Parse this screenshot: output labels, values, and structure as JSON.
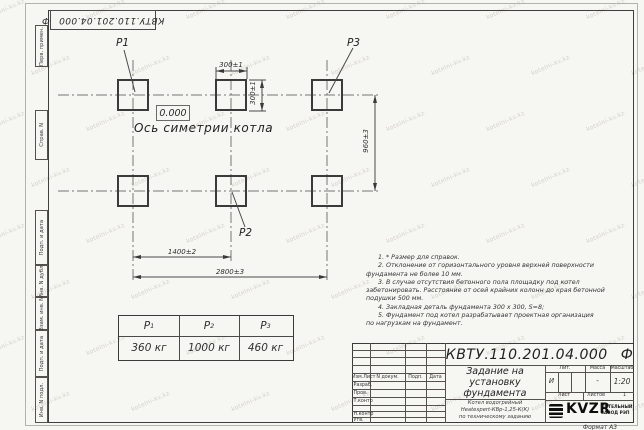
{
  "watermark": "kotelni-kv.kz",
  "doc": {
    "number": "КВТУ.110.201.04.000",
    "suffix": "Ф"
  },
  "margin_boxes": [
    "Перв. примен.",
    "Справ. N",
    "Подп. и дата",
    "Инв. N дубл.",
    "Взам. инв. N",
    "Подп. и дата",
    "Инв. N подл."
  ],
  "figure": {
    "p1": "P1",
    "p2": "P2",
    "p3": "P3",
    "elevation": "0.000",
    "axis_label": "Ось симетрии котла",
    "dim_width_top": "300±1",
    "dim_height_side": "300±1",
    "dim_vertical": "960±3",
    "dim_half_span": "1400±2",
    "dim_full_span": "2800±3"
  },
  "notes": {
    "lines": [
      "1. * Размер для справок.",
      "2. Отклонение от горизонтального уровня верхней поверхности",
      "фундамента не более 10 мм.",
      "3. В случае отсутствия бетонного пола площадку под котел",
      "забетонировать. Расстояние от осей крайних колонн до края бетонной",
      "подушки 500 мм.",
      "4. Закладная деталь фундамента 300 х 300, S=8;",
      "5. Фундамент под котел разрабатывает проектная организация",
      "по нагрузкам на фундамент."
    ]
  },
  "load_table": {
    "headers": [
      {
        "p": "P",
        "s": "1"
      },
      {
        "p": "P",
        "s": "2"
      },
      {
        "p": "P",
        "s": "3"
      }
    ],
    "values": [
      "360 кг",
      "1000 кг",
      "460 кг"
    ]
  },
  "title_block": {
    "rev_cols": [
      "Изм.Лист",
      "N докум.",
      "Подп.",
      "Дата"
    ],
    "roles": [
      "Разраб.",
      "Пров.",
      "Т.контр",
      "",
      "Н.контр",
      "Утв."
    ],
    "title_lines": [
      "Задание на",
      "установку",
      "фундамента"
    ],
    "subtitle_lines": [
      "Котел водогрейный",
      "Heatexpert-КВр-1,25-К(К)",
      "по техническому заданию"
    ],
    "lit_label": "Лит.",
    "mass_label": "Масса",
    "scale_label": "Масштаб",
    "lit_value": "И",
    "mass_value": "-",
    "scale_value": "1:20",
    "sheet_label": "Лист",
    "sheets_label": "Листов",
    "sheets_value": "1",
    "brand": "KVZR",
    "brand_sub_1": "КОТЕЛЬНЫЙ",
    "brand_sub_2": "ЗАВОД РЭП",
    "format": "Формат А3"
  }
}
